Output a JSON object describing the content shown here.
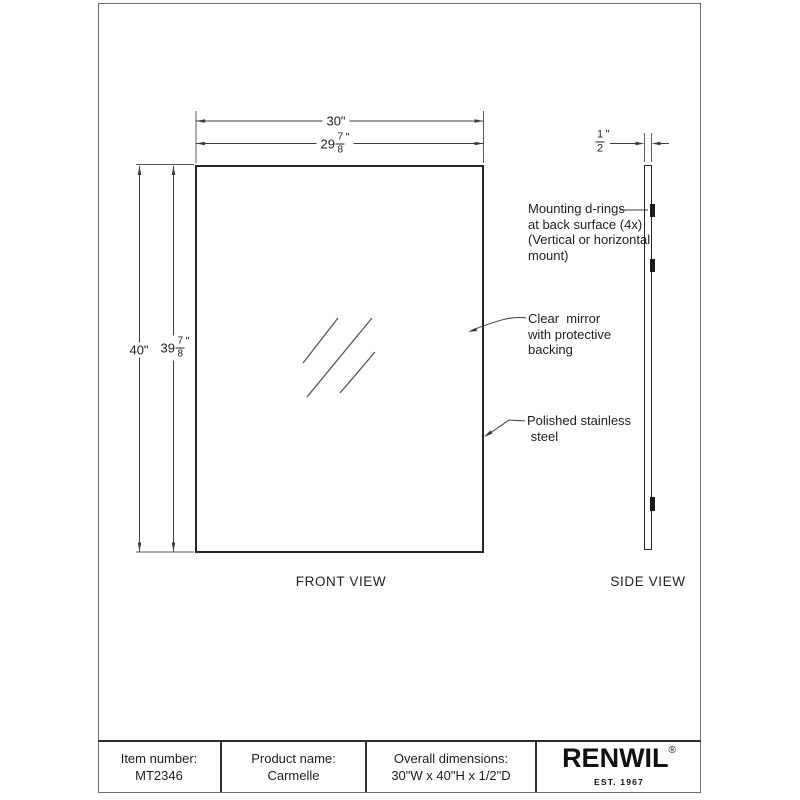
{
  "views": {
    "front_label": "FRONT VIEW",
    "side_label": "SIDE VIEW"
  },
  "dims": {
    "width_overall": "30\"",
    "width_mirror": {
      "whole": "29",
      "num": "7",
      "den": "8",
      "unit": "\""
    },
    "height_overall": "40\"",
    "height_mirror": {
      "whole": "39",
      "num": "7",
      "den": "8",
      "unit": "\""
    },
    "depth": {
      "num": "1",
      "den": "2",
      "unit": "\""
    }
  },
  "annotations": {
    "mounting": "Mounting d-rings\nat back surface (4x)\n(Vertical or horizontal\nmount)",
    "mirror": "Clear  mirror\nwith protective\nbacking",
    "frame": "Polished stainless\n steel"
  },
  "title_block": {
    "item_number_label": "Item number:",
    "item_number": "MT2346",
    "product_name_label": "Product name:",
    "product_name": "Carmelle",
    "overall_dimensions_label": "Overall dimensions:",
    "overall_dimensions": "30\"W x 40\"H x 1/2\"D",
    "brand": "RENWIL",
    "brand_registered": "®",
    "brand_tagline": "EST. 1967"
  },
  "colors": {
    "line": "#3d3d3d",
    "drawing_outline": "#262626",
    "background": "#ffffff"
  }
}
